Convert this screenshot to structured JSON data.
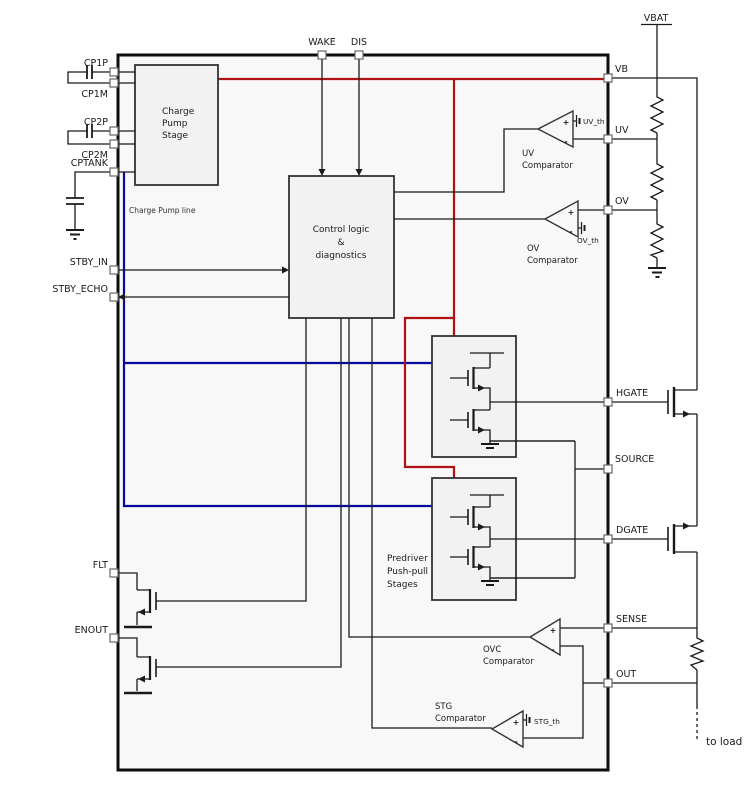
{
  "colors": {
    "vb_line": "#b01212",
    "charge_pump_line": "#0808a0",
    "wire": "#1a1a1a"
  },
  "external": {
    "vbat_label": "VBAT",
    "to_load_label": "to load"
  },
  "top_pins": [
    {
      "label": "WAKE"
    },
    {
      "label": "DIS"
    }
  ],
  "left_pins": [
    {
      "label": "CP1P"
    },
    {
      "label": "CP1M"
    },
    {
      "label": "CP2P"
    },
    {
      "label": "CP2M"
    },
    {
      "label": "CPTANK"
    },
    {
      "label": "STBY_IN"
    },
    {
      "label": "STBY_ECHO"
    },
    {
      "label": "FLT"
    },
    {
      "label": "ENOUT"
    }
  ],
  "right_pins": [
    {
      "label": "VB"
    },
    {
      "label": "UV"
    },
    {
      "label": "OV"
    },
    {
      "label": "HGATE"
    },
    {
      "label": "SOURCE"
    },
    {
      "label": "DGATE"
    },
    {
      "label": "SENSE"
    },
    {
      "label": "OUT"
    }
  ],
  "blocks": {
    "charge_pump": {
      "lines": [
        "Charge",
        "Pump",
        "Stage"
      ]
    },
    "control_logic": {
      "lines": [
        "Control logic",
        "&",
        "diagnostics"
      ]
    },
    "predriver": {
      "lines": [
        "Predriver",
        "Push-pull",
        "Stages"
      ]
    }
  },
  "comparators": {
    "uv": {
      "name": [
        "UV",
        "Comparator"
      ],
      "threshold": "UV_th",
      "plus": "+",
      "minus": "-"
    },
    "ov": {
      "name": [
        "OV",
        "Comparator"
      ],
      "threshold": "OV_th",
      "plus": "+",
      "minus": "-"
    },
    "ovc": {
      "name": [
        "OVC",
        "Comparator"
      ],
      "plus": "+",
      "minus": "-"
    },
    "stg": {
      "name": [
        "STG",
        "Comparator"
      ],
      "threshold": "STG_th",
      "plus": "+",
      "minus": "-"
    }
  },
  "annotations": {
    "charge_pump_line": "Charge Pump line"
  }
}
